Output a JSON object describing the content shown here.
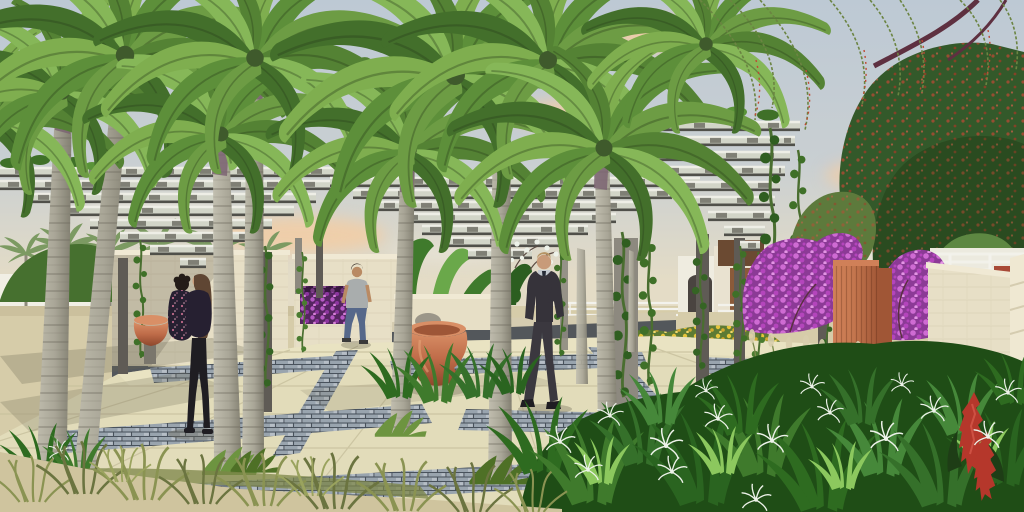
{
  "meta": {
    "title": "courtyard-garden-architectural-render",
    "canvas": {
      "width": 1024,
      "height": 512
    },
    "render_style": "photoreal 3d landscape visualization, no UI text visible"
  },
  "scene": {
    "description": "Landscaped courtyard promenade with royal palm trees growing through slatted steel pergola canopies, cream stone walls with recessed purple flower planters, terracotta urns, an orange pillar with bougainvillea, beige paver walkway with grey brick bands, and three people (embracing couple, walking man in grey tee, man in dark suit).",
    "objects": [
      {
        "name": "sky",
        "label": "pale blue-grey sky with peach clouds"
      },
      {
        "name": "weeping-branches",
        "label": "weeping bottlebrush branches with red blooms"
      },
      {
        "name": "right-tree-canopy",
        "label": "dense green tree mass with red flower speckles"
      },
      {
        "name": "background-wall",
        "label": "white perimeter wall"
      },
      {
        "name": "background-palm",
        "label": "distant small palm"
      },
      {
        "name": "background-building",
        "label": "cream building with brown door"
      },
      {
        "name": "garden-fence",
        "label": "white rail fence"
      },
      {
        "name": "road",
        "label": "light grey background road"
      },
      {
        "name": "pergola-left",
        "label": "stepped slat pergola canopy (left)"
      },
      {
        "name": "pergola-center",
        "label": "stepped slat pergola canopy (center)"
      },
      {
        "name": "pergola-right",
        "label": "stepped slat pergola canopy (right)"
      },
      {
        "name": "pergola-post",
        "label": "dark steel pergola column"
      },
      {
        "name": "vine",
        "label": "hanging green creeper"
      },
      {
        "name": "palm-trunk",
        "label": "ringed grey palm trunk"
      },
      {
        "name": "palm-crown",
        "label": "feathery palm frond crown"
      },
      {
        "name": "couple",
        "label": "embracing couple, floral black top and long brown hair"
      },
      {
        "name": "couple-pot",
        "label": "small terracotta pot on pedestal"
      },
      {
        "name": "walking-man",
        "label": "man in grey t-shirt and jeans"
      },
      {
        "name": "suited-man",
        "label": "man in dark suit with grey shirt and tie"
      },
      {
        "name": "white-blossom-tree",
        "label": "small white-flowering tree"
      },
      {
        "name": "stone-wall-left",
        "label": "cream stone wall behind couple"
      },
      {
        "name": "stone-wall-center",
        "label": "cream stone wall with purple planter"
      },
      {
        "name": "flower-planter",
        "label": "recessed planter of magenta flowers"
      },
      {
        "name": "banana-plants",
        "label": "paddle-leaf tropical plants"
      },
      {
        "name": "bench-wall",
        "label": "low charcoal wall with stone cap"
      },
      {
        "name": "terracotta-urn",
        "label": "terracotta urn fountain with stone"
      },
      {
        "name": "agapanthus-bed",
        "label": "strap-leaf bed with white blooms"
      },
      {
        "name": "yellow-flower-bed",
        "label": "yellow daisy bed"
      },
      {
        "name": "bougainvillea",
        "label": "magenta bougainvillea shrubs"
      },
      {
        "name": "orange-pillar",
        "label": "tall fluted orange pillar"
      },
      {
        "name": "stone-wall-right",
        "label": "cream stone wall (right)"
      },
      {
        "name": "terracotta-bowl",
        "label": "large terracotta bowl planter"
      },
      {
        "name": "plume-grass",
        "label": "feathery plume grasses"
      },
      {
        "name": "spider-lily-bed",
        "label": "spider lily bed with white flowers"
      },
      {
        "name": "red-ginger",
        "label": "red ginger flower spikes"
      },
      {
        "name": "pavement",
        "label": "beige paver plaza"
      },
      {
        "name": "brick-band",
        "label": "grey brick paving band"
      },
      {
        "name": "grass-tuft",
        "label": "green tuft at palm base"
      },
      {
        "name": "dry-grass",
        "label": "olive ornamental grass clumps"
      },
      {
        "name": "sand-ground",
        "label": "sandy ground"
      }
    ]
  },
  "palette": {
    "sky_top": "#bdc9d4",
    "sky_mid": "#c9cfd2",
    "sky_low": "#e4dcc6",
    "cloud_peach": "#f2cda4",
    "cloud_white": "#efece2",
    "tree_dark": "#33592a",
    "tree_deep": "#2a4b20",
    "tree_light": "#5d8742",
    "branch": "#5e3040",
    "weep_green": "#6b8442",
    "weep_red": "#bf4a34",
    "trunk_light": "#c2bfb0",
    "trunk_mid": "#a9a697",
    "trunk_dark": "#817e70",
    "trunk_ring": "#6e6b5e",
    "crownshaft": "#7b6472",
    "slat_top": "#eeeee6",
    "slat_face": "#d2d5c8",
    "slat_shadow": "#50504a",
    "slat_gap": "rgba(58,57,50,0.55)",
    "post": "#5f5b55",
    "post_light": "#8d897f",
    "vine_stem": "#4a6e30",
    "vine_leaf1": "#3f7028",
    "vine_leaf2": "#5a9438",
    "wall_cream": "#e7dfc6",
    "wall_cap": "#f0e9d4",
    "wall_shade": "#d5ccb0",
    "wall_course": "#cdc4a8",
    "wall_base": "#53575b",
    "wall_white": "#f1efe5",
    "recess_purple": "#552561",
    "purple1": "#b558c4",
    "purple2": "#8d36a0",
    "purple3": "#d77fd9",
    "bougain_base": "#8c3a96",
    "bougain1": "#cf6bd3",
    "bougain2": "#b445bc",
    "bougain3": "#e394e4",
    "banana": "#3f7a2c",
    "banana_light": "#6aa84a",
    "banana_dark": "#2c5e20",
    "pillar_front": "#c77950",
    "pillar_side": "#a05636",
    "pillar_top": "#d08058",
    "terr_light": "#d98f66",
    "terr_mid": "#bf6c49",
    "terr_dark": "#8e472c",
    "sand": "#d6cca9",
    "sand_light": "#cfc49e",
    "pave": "#e2dcba",
    "pave_light": "#ece6c6",
    "pave_joint": "#c8c19e",
    "brick_base": "#99a4ae",
    "brick_light": "#b6bec6",
    "brick_line": "#49525c",
    "shadow": "#6d6852",
    "bed_dark": "#1f4d16",
    "leaf_hi": "#8cc85e",
    "flower_white": "#edf2e9",
    "yellow_base": "#5d7a34",
    "yellow1": "#e6c53c",
    "yellow2": "#d4a92e",
    "yellow3": "#f0d86a",
    "ginger_red": "#b5372b",
    "ginger_hi": "#d4574a",
    "ginger_leaf": "#1e3d16",
    "plume_stem": "#7c8a4e",
    "plume": "#d9cfae",
    "grass_olive": "#8a9352",
    "skin": "#c89b79",
    "skin2": "#b98a63",
    "hair_blond": "#b59363",
    "hair_dark": "#2f2620",
    "hair_brown": "#5f4633",
    "hair_black": "#241c18",
    "suit": "#36333a",
    "trouser": "#3b383f",
    "shirt": "#c3c9cf",
    "tie": "#262b36",
    "shoe": "#1f1d22",
    "tee": "#a9adad",
    "jeans": "#56688a",
    "top_black": "#262031",
    "floral_pink": "#c06a8a",
    "building": "#e9e2d0",
    "building_white": "#efece0",
    "door": "#8a5a3a",
    "arch": "#4a4440",
    "brickred": "#a84a38",
    "fence": "#f3f2ec",
    "road": "#c9c8c2",
    "door_brown": "#6b4a32",
    "rock": "#9b9689",
    "pedestal": "#7a766c",
    "frond_rib": "rgba(40,60,25,0.35)"
  },
  "palms": {
    "frond_angles": [
      -80,
      -52,
      -24,
      2,
      28,
      54
    ],
    "frond_scales": [
      0.72,
      0.9,
      1.0,
      1.0,
      0.92,
      0.75
    ],
    "frond_cycle": [
      "#7fae4f",
      "#5d8f3a",
      "#6d9c44",
      "#548234",
      "#86b758",
      "#436f2b"
    ],
    "crowns": [
      [
        -8,
        118,
        1.5
      ],
      [
        62,
        92,
        1.55
      ],
      [
        125,
        55,
        1.85
      ],
      [
        221,
        134,
        1.5
      ],
      [
        255,
        58,
        1.75
      ],
      [
        409,
        150,
        1.55
      ],
      [
        455,
        75,
        2.0
      ],
      [
        548,
        60,
        1.8
      ],
      [
        604,
        148,
        1.7
      ],
      [
        706,
        44,
        1.35
      ]
    ]
  },
  "pergolas": [
    {
      "id": "pergola-left",
      "vtop": 168,
      "dy": 13,
      "n": 8,
      "l0": -30,
      "dl": 30,
      "r0": 360,
      "dr": 22
    },
    {
      "id": "pergola-center",
      "vtop": 178,
      "dy": 12,
      "n": 8,
      "l0": 330,
      "dl": 23,
      "r0": 700,
      "dr": 28
    },
    {
      "id": "pergola-right",
      "vtop": 122,
      "dy": 15,
      "n": 9,
      "l0": 612,
      "dl": 16,
      "r0": 800,
      "dr": 5
    }
  ],
  "scatter": {
    "bgpalms": [
      [
        26,
        252,
        1.0
      ],
      [
        66,
        246,
        1.2
      ],
      [
        110,
        250,
        1.1
      ],
      [
        158,
        243,
        1.3
      ],
      [
        214,
        247,
        1.2
      ],
      [
        266,
        250,
        1.0
      ]
    ],
    "bgpalm_color": "#7c9a62",
    "vines": [
      [
        140,
        240,
        1.0,
        "#3f7028"
      ],
      [
        265,
        246,
        1.2,
        "#356424"
      ],
      [
        302,
        252,
        0.85,
        "#4a7c30"
      ],
      [
        560,
        250,
        0.9,
        "#3f7028"
      ],
      [
        622,
        232,
        1.4,
        "#2f5e20"
      ],
      [
        648,
        238,
        1.25,
        "#3f7028"
      ],
      [
        700,
        240,
        1.1,
        "#356424"
      ],
      [
        740,
        246,
        1.05,
        "#3f7028"
      ],
      [
        770,
        128,
        1.5,
        "#2f5e20"
      ],
      [
        798,
        150,
        1.2,
        "#3f7028"
      ],
      [
        826,
        250,
        0.9,
        "#356424"
      ],
      [
        758,
        252,
        1.0,
        "#4a7c30"
      ]
    ],
    "tufts": [
      [
        50,
        506,
        1.7,
        "#6d9440"
      ],
      [
        82,
        508,
        1.5,
        "#4e7026"
      ],
      [
        229,
        472,
        1.5,
        "#6d9440"
      ],
      [
        254,
        470,
        1.3,
        "#4e7026"
      ],
      [
        400,
        434,
        1.4,
        "#6d9440"
      ],
      [
        500,
        481,
        1.7,
        "#4e7026"
      ],
      [
        608,
        447,
        1.5,
        "#6d9440"
      ],
      [
        14,
        508,
        2.0,
        "#5d8f3a"
      ],
      [
        52,
        512,
        1.8,
        "#4e7026"
      ]
    ],
    "clumps": [
      [
        28,
        502,
        1.4,
        "#8a9352"
      ],
      [
        78,
        494,
        1.6,
        "#6b7440"
      ],
      [
        138,
        500,
        1.7,
        "#8a9352"
      ],
      [
        198,
        504,
        1.5,
        "#6b7440"
      ],
      [
        258,
        506,
        1.6,
        "#8a9352"
      ],
      [
        328,
        509,
        1.7,
        "#6b7440"
      ],
      [
        398,
        511,
        1.6,
        "#8a9352"
      ],
      [
        468,
        512,
        1.5,
        "#6b7440"
      ],
      [
        118,
        482,
        1.1,
        "#9aa35e"
      ],
      [
        308,
        496,
        1.2,
        "#9aa35e"
      ],
      [
        528,
        512,
        1.3,
        "#8a9352"
      ]
    ],
    "blades": [
      [
        398,
        396,
        1.1,
        "#2e6b20"
      ],
      [
        436,
        400,
        1.25,
        "#3f7a2c"
      ],
      [
        478,
        396,
        1.15,
        "#35702a"
      ],
      [
        512,
        392,
        1.0,
        "#2a6420"
      ],
      [
        540,
        470,
        1.6,
        "#2e6b20"
      ],
      [
        590,
        500,
        1.8,
        "#3f7a2c"
      ],
      [
        640,
        462,
        1.5,
        "#35702a"
      ],
      [
        700,
        500,
        2.0,
        "#2a6420"
      ],
      [
        760,
        472,
        1.7,
        "#3f7a2c"
      ],
      [
        820,
        506,
        1.9,
        "#2e6b20"
      ],
      [
        880,
        472,
        1.6,
        "#46883a"
      ],
      [
        940,
        502,
        1.8,
        "#35702a"
      ],
      [
        1000,
        482,
        1.6,
        "#2a6420"
      ],
      [
        660,
        422,
        1.2,
        "#46883a"
      ],
      [
        740,
        432,
        1.3,
        "#2e6b20"
      ],
      [
        860,
        422,
        1.2,
        "#35702a"
      ],
      [
        960,
        432,
        1.3,
        "#46883a"
      ],
      [
        1012,
        402,
        1.1,
        "#2e6b20"
      ],
      [
        600,
        482,
        1.0,
        "#8cc85e"
      ],
      [
        722,
        472,
        1.0,
        "#8cc85e"
      ],
      [
        842,
        487,
        1.0,
        "#8cc85e"
      ],
      [
        982,
        462,
        0.9,
        "#8cc85e"
      ],
      [
        40,
        478,
        1.2,
        "#2e6b20"
      ],
      [
        76,
        474,
        1.0,
        "#3f7a2c"
      ]
    ],
    "lilies": [
      [
        560,
        442,
        0.9
      ],
      [
        610,
        416,
        0.8
      ],
      [
        666,
        446,
        1.0
      ],
      [
        718,
        419,
        0.85
      ],
      [
        772,
        441,
        0.95
      ],
      [
        830,
        413,
        0.8
      ],
      [
        886,
        439,
        1.0
      ],
      [
        934,
        411,
        0.85
      ],
      [
        988,
        437,
        0.9
      ],
      [
        706,
        391,
        0.7
      ],
      [
        812,
        387,
        0.75
      ],
      [
        902,
        385,
        0.7
      ],
      [
        1008,
        393,
        0.8
      ],
      [
        672,
        472,
        0.9
      ],
      [
        588,
        470,
        0.85
      ],
      [
        756,
        500,
        0.9
      ],
      [
        60,
        452,
        0.7
      ]
    ],
    "lily_color": "#edf2e9"
  }
}
